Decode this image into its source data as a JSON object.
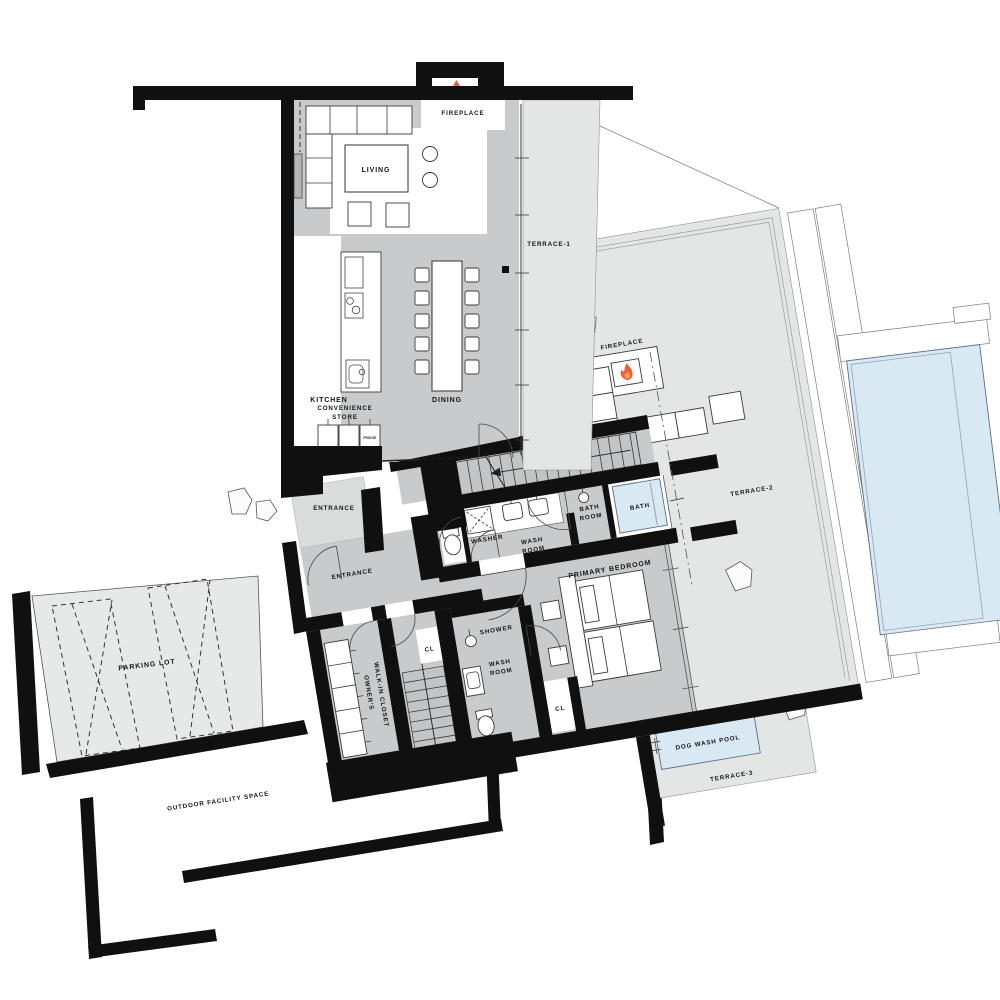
{
  "plan": {
    "title": "residence-floor-plan",
    "labels": {
      "fireplace_main": "FIREPLACE",
      "tv": "TV",
      "living": "LIVING",
      "terrace1": "TERRACE-1",
      "kitchen": "KITCHEN",
      "dining": "DINING",
      "convenience_l1": "CONVENIENCE",
      "convenience_l2": "STORE",
      "fridge": "FRIDGE",
      "entrance_porch": "ENTRANCE",
      "entrance_hall": "ENTRANCE",
      "fireplace_terrace": "FIREPLACE",
      "terrace2": "TERRACE-2",
      "washer": "WASHER",
      "washroom1_l1": "WASH",
      "washroom1_l2": "ROOM",
      "bathroom_l1": "BATH",
      "bathroom_l2": "ROOM",
      "bath": "BATH",
      "primary_bedroom": "PRIMARY BEDROOM",
      "shower": "SHOWER",
      "washroom2_l1": "WASH",
      "washroom2_l2": "ROOM",
      "cl_stairs": "CL",
      "cl_bedroom": "CL",
      "closet_l1": "OWNER'S",
      "closet_l2": "WALK-IN CLOSET",
      "parking": "PARKING LOT",
      "outdoor": "OUTDOOR FACILITY SPACE",
      "dogwash": "DOG WASH POOL",
      "terrace3": "TERRACE-3"
    },
    "colors": {
      "wall": "#101010",
      "interior_floor": "#c9cacb",
      "terrace_floor": "#e4e6e5",
      "parking_floor": "#e7e9e8",
      "water": "#d9e9f3",
      "flame_outer": "#e8603c",
      "flame_inner": "#f6a04c",
      "line": "#3c3c3c"
    }
  }
}
